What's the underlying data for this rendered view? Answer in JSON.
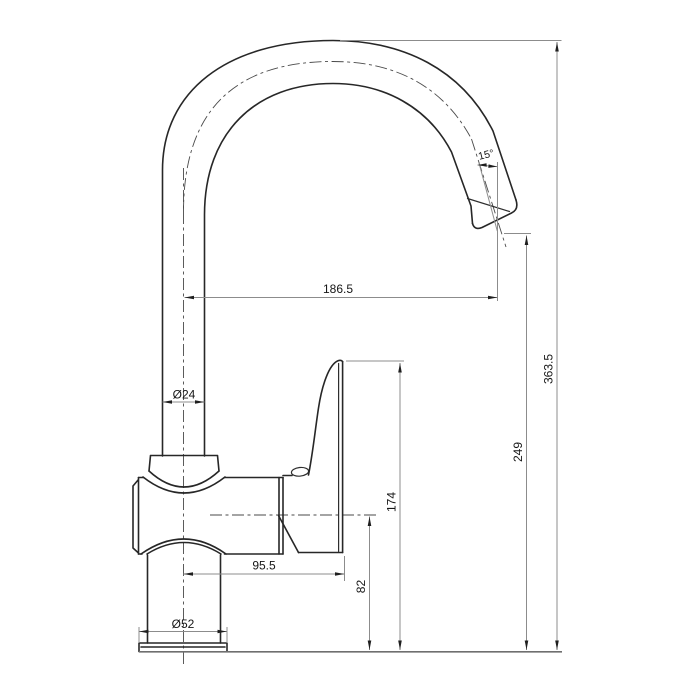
{
  "drawing": {
    "title": "Kitchen faucet dimensional drawing (side elevation)",
    "background_color": "#ffffff",
    "outline_color": "#272727",
    "dimension_color": "#8c8c8c",
    "labels": {
      "spout_reach": "186.5",
      "overall_height": "363.5",
      "outlet_height": "249",
      "handle_top_height": "174",
      "body_center_height": "82",
      "center_to_handle_end": "95.5",
      "column_diameter": "Ø24",
      "base_diameter": "Ø52",
      "spout_angle": "15°"
    }
  }
}
